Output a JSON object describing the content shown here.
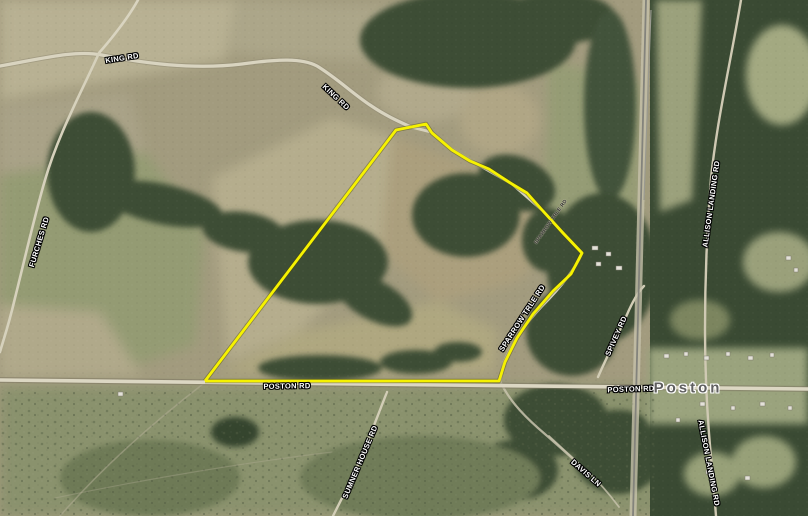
{
  "map": {
    "type": "aerial-parcel-map",
    "place": "Poston"
  },
  "parcel": {
    "outline_color": "#f6f200",
    "casing_color": "#4d4a00",
    "points": "205,381 396,130 426,124 432,133 452,150 470,161 489,169 512,184 527,193 543,211 563,233 582,253 571,274 553,291 533,314 517,338 505,362 499,381 205,381"
  },
  "labels": {
    "king_rd_1": "KING RD",
    "king_rd_2": "KING RD",
    "furches_rd": "FURCHES RD",
    "poston_rd_left": "POSTON RD",
    "sparrow_rd": "SPARROW TRLE RD",
    "sparrow_rd_small": "SPARROW TRLE RD",
    "spivey_rd": "SPIVEY RD",
    "poston_rd_right": "POSTON RD",
    "allison_landing_top": "ALLISON LANDING RD",
    "allison_landing_bottom": "ALLISON LANDING RD",
    "davis_ln": "DAVIS LN",
    "sumner_house_rd": "SUMNER HOUSE RD",
    "place_poston": "Poston"
  },
  "colors": {
    "field_tan": "#b2aa8b",
    "field_olive": "#8f976f",
    "forest_green": "#3d4d35",
    "scrub": "#87906b",
    "road": "#dcd7c3",
    "rail": "#83837c",
    "parcel_yellow": "#f6f200",
    "road_label_text": "#ffffff",
    "road_label_outline": "#000000",
    "place_text": "#5f5f5f"
  }
}
